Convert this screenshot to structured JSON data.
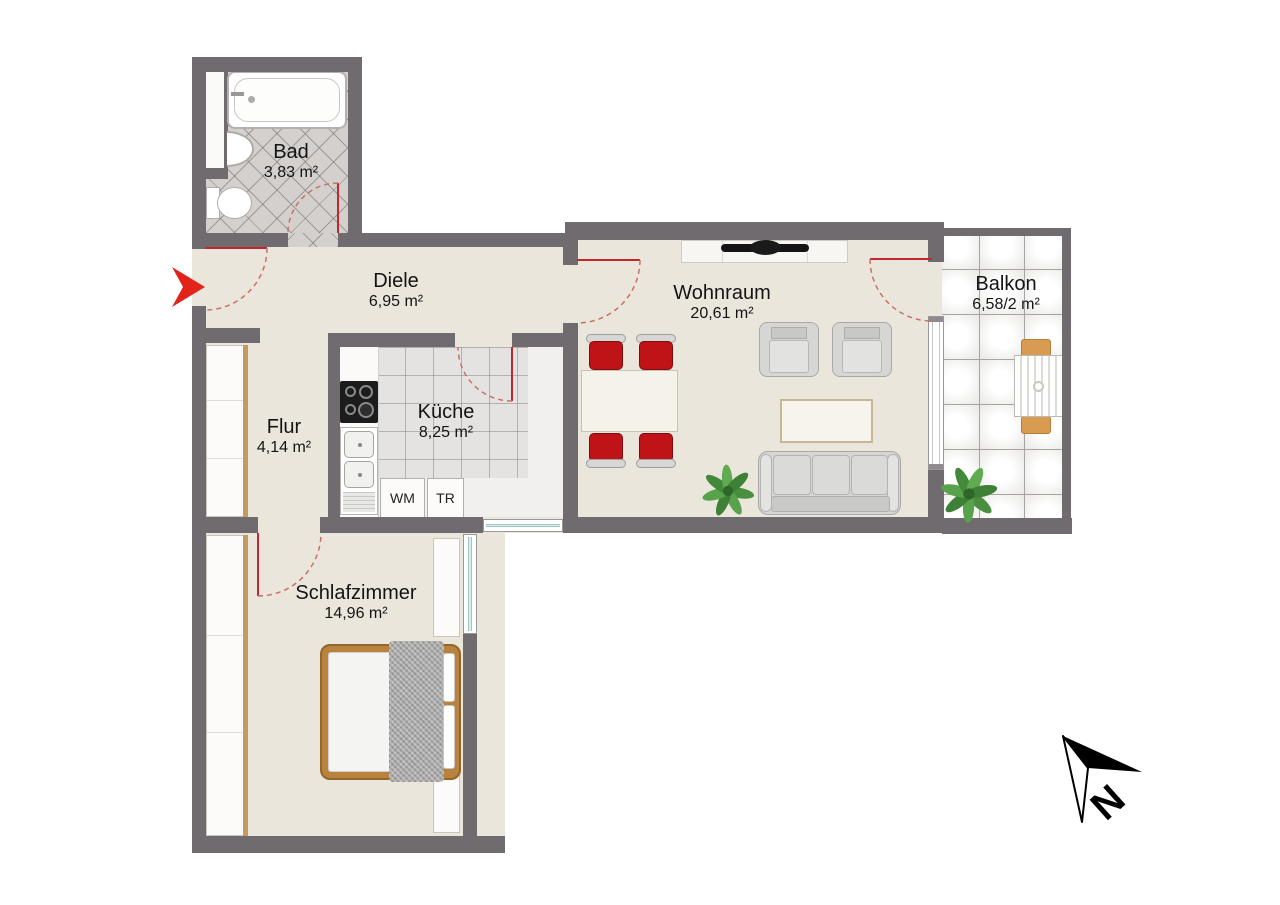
{
  "plan": {
    "rooms": [
      {
        "id": "bad",
        "name": "Bad",
        "area": "3,83 m²"
      },
      {
        "id": "diele",
        "name": "Diele",
        "area": "6,95 m²"
      },
      {
        "id": "flur",
        "name": "Flur",
        "area": "4,14 m²"
      },
      {
        "id": "kueche",
        "name": "Küche",
        "area": "8,25 m²"
      },
      {
        "id": "wohnraum",
        "name": "Wohnraum",
        "area": "20,61 m²"
      },
      {
        "id": "schlafzimmer",
        "name": "Schlafzimmer",
        "area": "14,96 m²"
      },
      {
        "id": "balkon",
        "name": "Balkon",
        "area": "6,58/2 m²"
      }
    ],
    "appliances": {
      "washing_machine": "WM",
      "dryer": "TR"
    },
    "compass": {
      "north_label": "N"
    },
    "colors": {
      "wall": "#6f6b6e",
      "floor": "#eae6dc",
      "accent_red": "#c1272d",
      "wood": "#b9823f"
    }
  }
}
